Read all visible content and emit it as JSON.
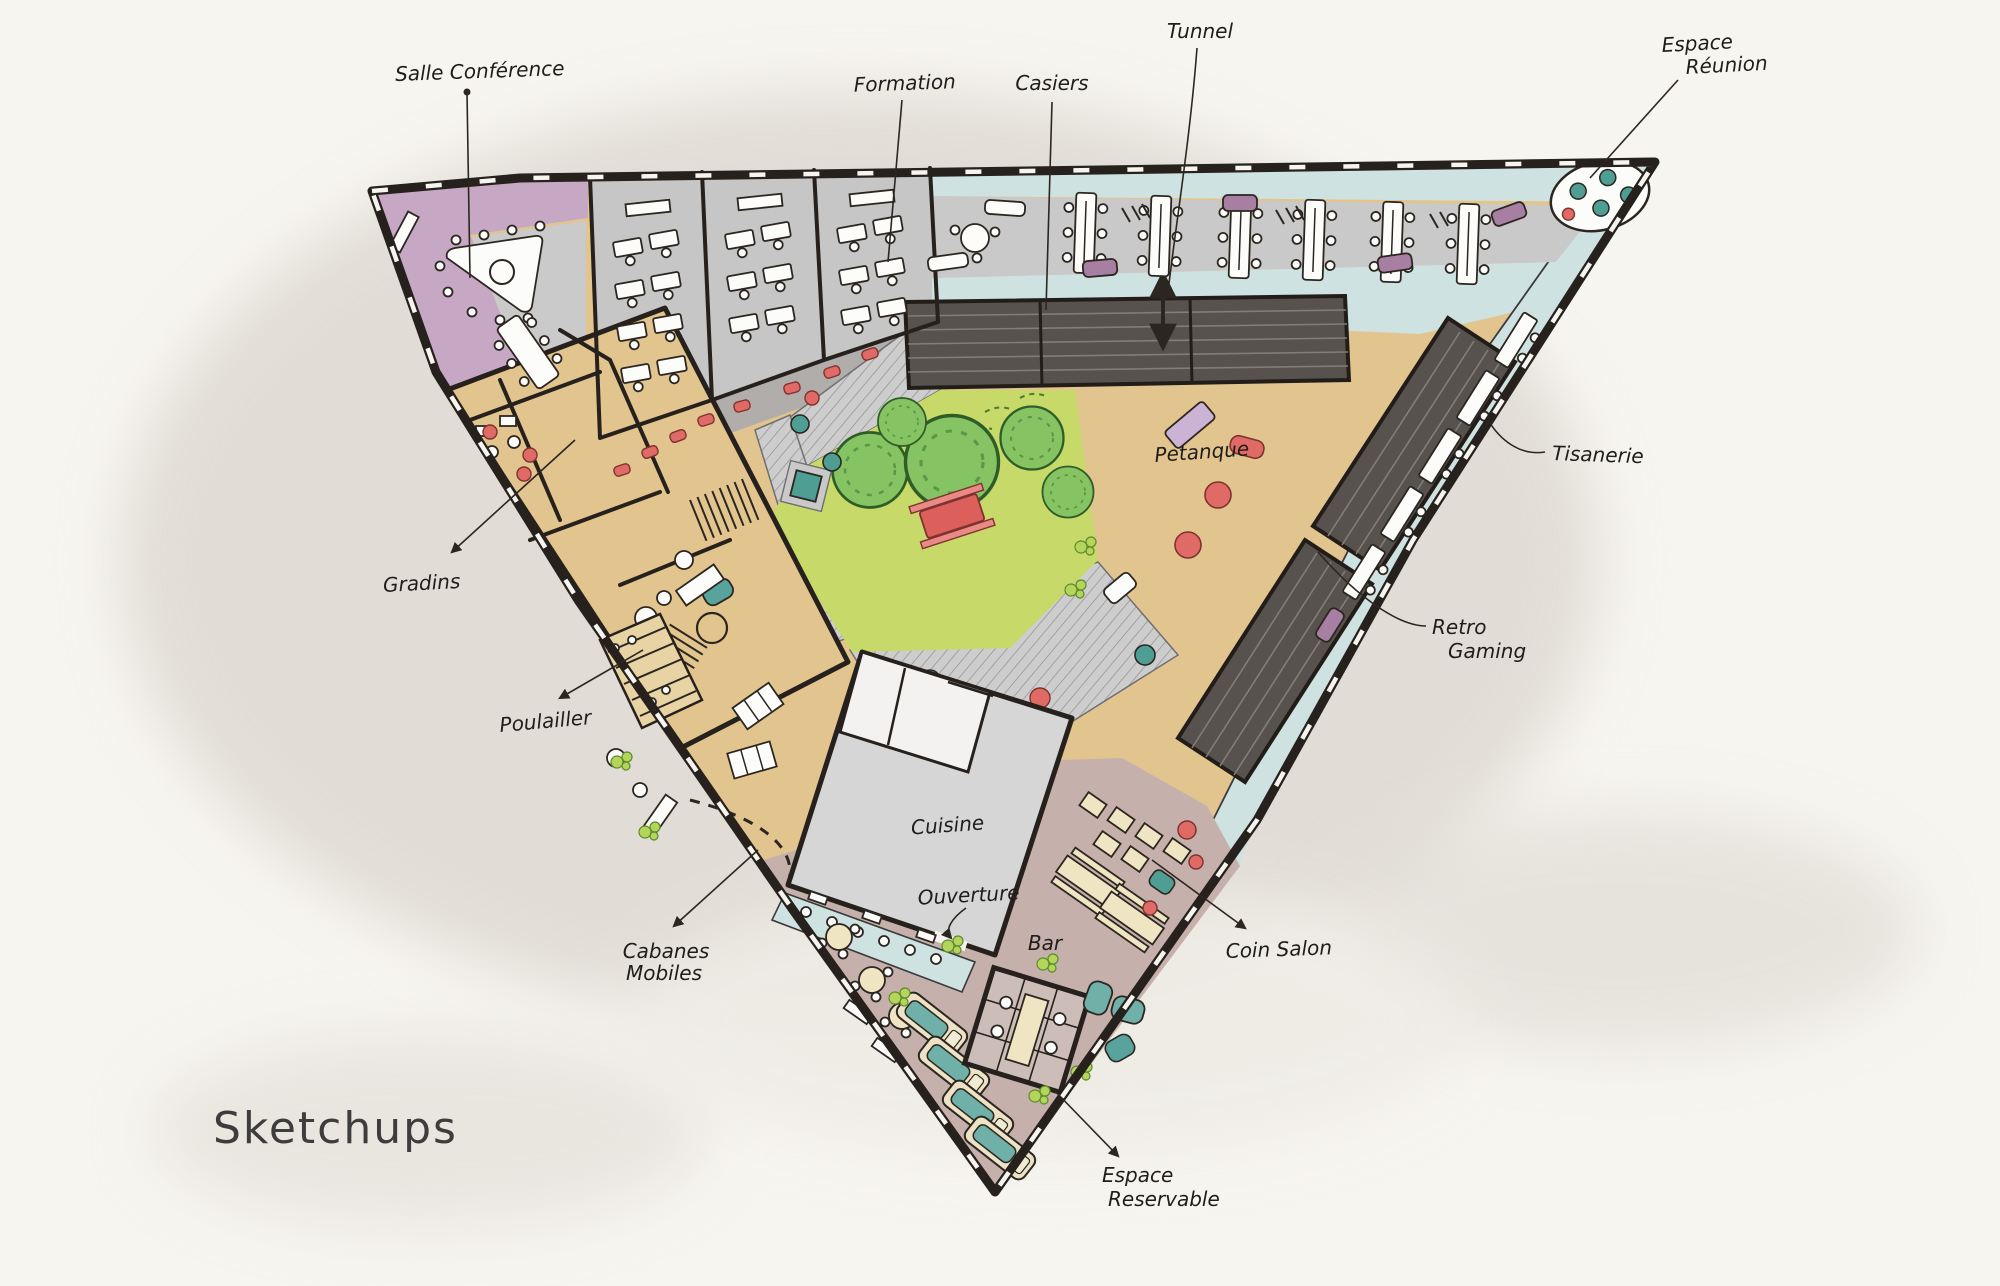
{
  "title": {
    "text": "Sketchups"
  },
  "annotations": {
    "salle_conference": {
      "label": "Salle Conférence"
    },
    "formation": {
      "label": "Formation"
    },
    "casiers": {
      "label": "Casiers"
    },
    "tunnel": {
      "label": "Tunnel"
    },
    "espace_reunion": {
      "line1": "Espace",
      "line2": "Réunion"
    },
    "tisanerie": {
      "label": "Tisanerie"
    },
    "retro_gaming": {
      "line1": "Retro",
      "line2": "Gaming"
    },
    "gradins": {
      "label": "Gradins"
    },
    "poulailler": {
      "label": "Poulailler"
    },
    "cabanes_mobiles": {
      "line1": "Cabanes",
      "line2": "Mobiles"
    },
    "petanque": {
      "label": "Petanque"
    },
    "cuisine": {
      "label": "Cuisine"
    },
    "ouverture": {
      "label": "Ouverture"
    },
    "bar": {
      "label": "Bar"
    },
    "coin_salon": {
      "label": "Coin Salon"
    },
    "espace_reservable": {
      "line1": "Espace",
      "line2": "Reservable"
    }
  },
  "colors": {
    "paper": "#f7f5f0",
    "watercolor_wash": "#dcd8d0",
    "ink": "#2c2620",
    "label_ink": "#1f1d1b",
    "purple_zone": "#c6a8c4",
    "blue_zone": "#cfe2e2",
    "gray_floor": "#cacaca",
    "corridor_gray": "#b0adaa",
    "tan_floor": "#e2c48f",
    "garden_green": "#c7da69",
    "tree_green": "#86c363",
    "dark_structure": "#57524d",
    "mauve_floor": "#c6b0ac",
    "cream": "#efe5c2",
    "teal": "#4f9e94",
    "red": "#e06a66",
    "sofa_purple": "#a77fa3",
    "title_gray": "#3d3d3d"
  }
}
